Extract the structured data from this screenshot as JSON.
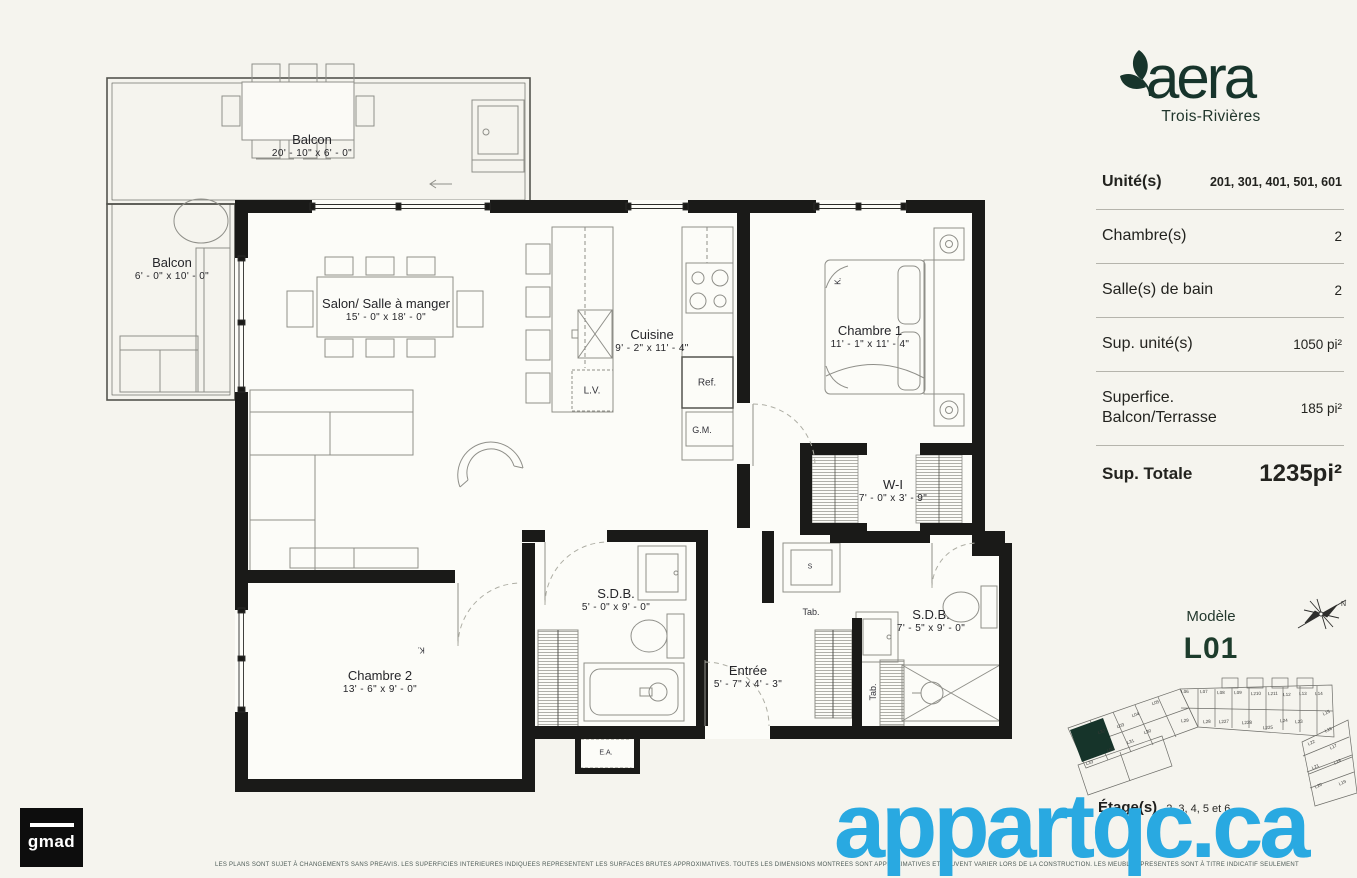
{
  "colors": {
    "accent_green": "#1d3c2c",
    "watermark_blue": "#29a9e1",
    "wall_black": "#1a1a18"
  },
  "brand": {
    "logo": "aera",
    "city": "Trois-Rivières"
  },
  "specs": [
    {
      "label": "Unité(s)",
      "value": "201, 301, 401, 501, 601",
      "style": "units"
    },
    {
      "label": "Chambre(s)",
      "value": "2",
      "style": "normal"
    },
    {
      "label": "Salle(s) de bain",
      "value": "2",
      "style": "normal"
    },
    {
      "label": "Sup. unité(s)",
      "value": "1050 pi²",
      "style": "normal"
    },
    {
      "label": "Superfice.\nBalcon/Terrasse",
      "value": "185 pi²",
      "style": "normal"
    },
    {
      "label": "Sup. Totale",
      "value": "1235pi²",
      "style": "total"
    }
  ],
  "model": {
    "caption": "Modèle",
    "name": "L01",
    "compass": "N",
    "floors_label": "Étage(s)",
    "floors": "2, 3, 4, 5 et 6"
  },
  "floor_plan": {
    "rooms": [
      {
        "id": "balcon-top",
        "name": "Balcon",
        "dims": "20' - 10\"  x  6' - 0\"",
        "x": 312,
        "y": 146
      },
      {
        "id": "balcon-left",
        "name": "Balcon",
        "dims": "6' - 0\"  x  10' - 0\"",
        "x": 172,
        "y": 269
      },
      {
        "id": "salon",
        "name": "Salon/ Salle à manger",
        "dims": "15' - 0\"  x  18' - 0\"",
        "x": 386,
        "y": 310
      },
      {
        "id": "cuisine",
        "name": "Cuisine",
        "dims": "9' - 2\"  x  11' - 4\"",
        "x": 652,
        "y": 341
      },
      {
        "id": "chambre-1",
        "name": "Chambre 1",
        "dims": "11' - 1\"  x  11' - 4\"",
        "x": 870,
        "y": 337
      },
      {
        "id": "walk-in",
        "name": "W-I",
        "dims": "7' - 0\"  x  3' - 9\"",
        "x": 893,
        "y": 491
      },
      {
        "id": "sdb-1",
        "name": "S.D.B.",
        "dims": "5' - 0\"  x  9' - 0\"",
        "x": 616,
        "y": 600
      },
      {
        "id": "chambre-2",
        "name": "Chambre 2",
        "dims": "13' - 6\"  x  9' - 0\"",
        "x": 380,
        "y": 682
      },
      {
        "id": "entree",
        "name": "Entrée",
        "dims": "5' - 7\"  x  4' - 3\"",
        "x": 748,
        "y": 677
      },
      {
        "id": "sdb-2",
        "name": "S.D.B.",
        "dims": "7' - 5\"  x  9' - 0\"",
        "x": 931,
        "y": 621
      }
    ],
    "fixtures": [
      {
        "label": "L.V.",
        "x": 592,
        "y": 391,
        "size": 10,
        "rot": 0
      },
      {
        "label": "Ref.",
        "x": 707,
        "y": 383,
        "size": 10,
        "rot": 0
      },
      {
        "label": "G.M.",
        "x": 702,
        "y": 430,
        "size": 9,
        "rot": 0
      },
      {
        "label": "Tab.",
        "x": 811,
        "y": 612,
        "size": 9,
        "rot": 0
      },
      {
        "label": "Tab.",
        "x": 873,
        "y": 692,
        "size": 9,
        "rot": -90
      },
      {
        "label": "K.",
        "x": 838,
        "y": 281,
        "size": 8,
        "rot": -90
      },
      {
        "label": "K.",
        "x": 421,
        "y": 650,
        "size": 8,
        "rot": 180
      },
      {
        "label": "S",
        "x": 810,
        "y": 567,
        "size": 7,
        "rot": 0
      },
      {
        "label": "E.A.",
        "x": 606,
        "y": 753,
        "size": 7,
        "rot": 0
      }
    ]
  },
  "minimap": {
    "highlighted_unit": "L01",
    "units": [
      {
        "label": "L06",
        "x": 1185,
        "y": 693,
        "r": -2
      },
      {
        "label": "L07",
        "x": 1204,
        "y": 693,
        "r": -2
      },
      {
        "label": "L08",
        "x": 1221,
        "y": 694,
        "r": -2
      },
      {
        "label": "L09",
        "x": 1238,
        "y": 694,
        "r": -2
      },
      {
        "label": "L210",
        "x": 1256,
        "y": 695,
        "r": -2
      },
      {
        "label": "L211",
        "x": 1273,
        "y": 695,
        "r": -2
      },
      {
        "label": "L12",
        "x": 1287,
        "y": 696,
        "r": -2
      },
      {
        "label": "L13",
        "x": 1303,
        "y": 695,
        "r": -2
      },
      {
        "label": "L14",
        "x": 1319,
        "y": 695,
        "r": -2
      },
      {
        "label": "L05",
        "x": 1156,
        "y": 704,
        "r": -19
      },
      {
        "label": "L04",
        "x": 1136,
        "y": 716,
        "r": -19
      },
      {
        "label": "L03",
        "x": 1121,
        "y": 727,
        "r": -19
      },
      {
        "label": "L02",
        "x": 1111,
        "y": 751,
        "r": -19
      },
      {
        "label": "L33",
        "x": 1090,
        "y": 764,
        "r": -19
      },
      {
        "label": "L32",
        "x": 1102,
        "y": 733,
        "r": -19
      },
      {
        "label": "L31",
        "x": 1131,
        "y": 743,
        "r": -19
      },
      {
        "label": "L30",
        "x": 1148,
        "y": 733,
        "r": -19
      },
      {
        "label": "L29",
        "x": 1185,
        "y": 722,
        "r": -3
      },
      {
        "label": "L28",
        "x": 1207,
        "y": 723,
        "r": -3
      },
      {
        "label": "L227",
        "x": 1224,
        "y": 723,
        "r": -3
      },
      {
        "label": "L228",
        "x": 1247,
        "y": 724,
        "r": -3
      },
      {
        "label": "L225",
        "x": 1268,
        "y": 729,
        "r": -3
      },
      {
        "label": "L24",
        "x": 1284,
        "y": 722,
        "r": -3
      },
      {
        "label": "L23",
        "x": 1299,
        "y": 723,
        "r": -3
      },
      {
        "label": "L15",
        "x": 1327,
        "y": 714,
        "r": -25
      },
      {
        "label": "L16",
        "x": 1329,
        "y": 731,
        "r": -25
      },
      {
        "label": "L22",
        "x": 1312,
        "y": 744,
        "r": -25
      },
      {
        "label": "L17",
        "x": 1334,
        "y": 748,
        "r": -25
      },
      {
        "label": "L21",
        "x": 1316,
        "y": 768,
        "r": -25
      },
      {
        "label": "L18",
        "x": 1338,
        "y": 763,
        "r": -25
      },
      {
        "label": "L20",
        "x": 1319,
        "y": 787,
        "r": -25
      },
      {
        "label": "L19",
        "x": 1343,
        "y": 784,
        "r": -25
      }
    ]
  },
  "watermark": "appartqc.ca",
  "footer": {
    "logo": "gmad",
    "disclaimer": "LES PLANS SONT SUJET À CHANGEMENTS SANS PREAVIS. LES SUPERFICIES INTERIEURES INDIQUEES REPRESENTENT LES SURFACES BRUTES APPROXIMATIVES. TOUTES LES DIMENSIONS MONTREES SONT APPROXIMATIVES ET PEUVENT VARIER LORS DE LA CONSTRUCTION. LES MEUBLES PRESENTES SONT À TITRE INDICATIF SEULEMENT"
  }
}
